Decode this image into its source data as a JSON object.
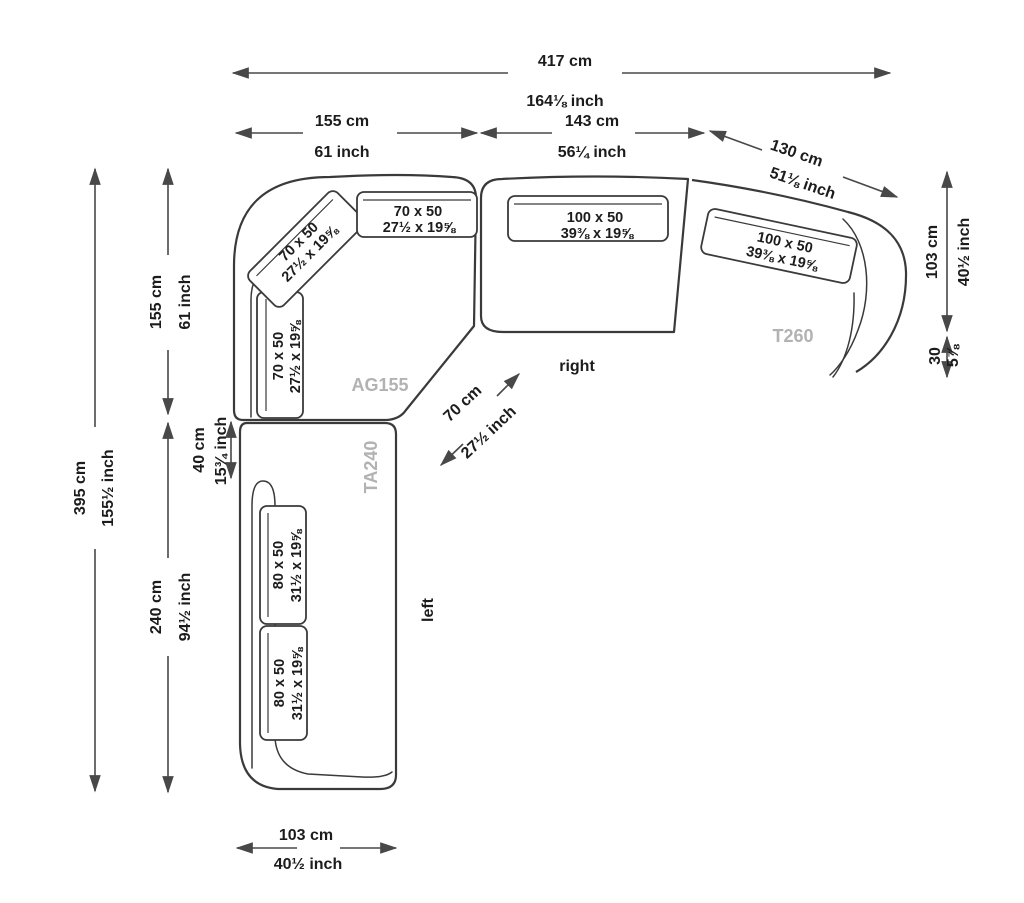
{
  "title": "Sectional sofa dimension diagram",
  "colors": {
    "outline": "#3a3a3a",
    "dimension_line": "#484848",
    "text": "#1c1c1c",
    "module_label": "#b2b2b2",
    "background": "#ffffff"
  },
  "dims": {
    "total_width": {
      "cm": "417 cm",
      "inch": "164⅛ inch"
    },
    "segment_corner": {
      "cm": "155 cm",
      "inch": "61 inch"
    },
    "segment_right": {
      "cm": "143 cm",
      "inch": "56¼ inch"
    },
    "segment_t260": {
      "cm": "130 cm",
      "inch": "51⅛ inch"
    },
    "depth_right": {
      "cm": "103 cm",
      "inch": "40½ inch"
    },
    "arm_right": {
      "cm": "30",
      "inch": "5⅞"
    },
    "total_height": {
      "cm": "395 cm",
      "inch": "155½ inch"
    },
    "corner_height": {
      "cm": "155 cm",
      "inch": "61 inch"
    },
    "offset_left": {
      "cm": "40 cm",
      "inch": "15¾ inch"
    },
    "chaise_length": {
      "cm": "240 cm",
      "inch": "94½ inch"
    },
    "depth_bottom": {
      "cm": "103 cm",
      "inch": "40½ inch"
    },
    "seat_width_diag": {
      "cm": "70 cm",
      "inch": "27½ inch"
    }
  },
  "cushions": {
    "small": {
      "cm": "70 x 50",
      "inch": "27½ x 19⅝"
    },
    "large": {
      "cm": "100 x 50",
      "inch": "39⅜ x 19⅝"
    },
    "medium": {
      "cm": "80 x 50",
      "inch": "31½ x 19⅝"
    }
  },
  "modules": {
    "corner": "AG155",
    "chaise": "TA240",
    "end": "T260"
  },
  "orientation": {
    "right": "right",
    "left": "left"
  }
}
